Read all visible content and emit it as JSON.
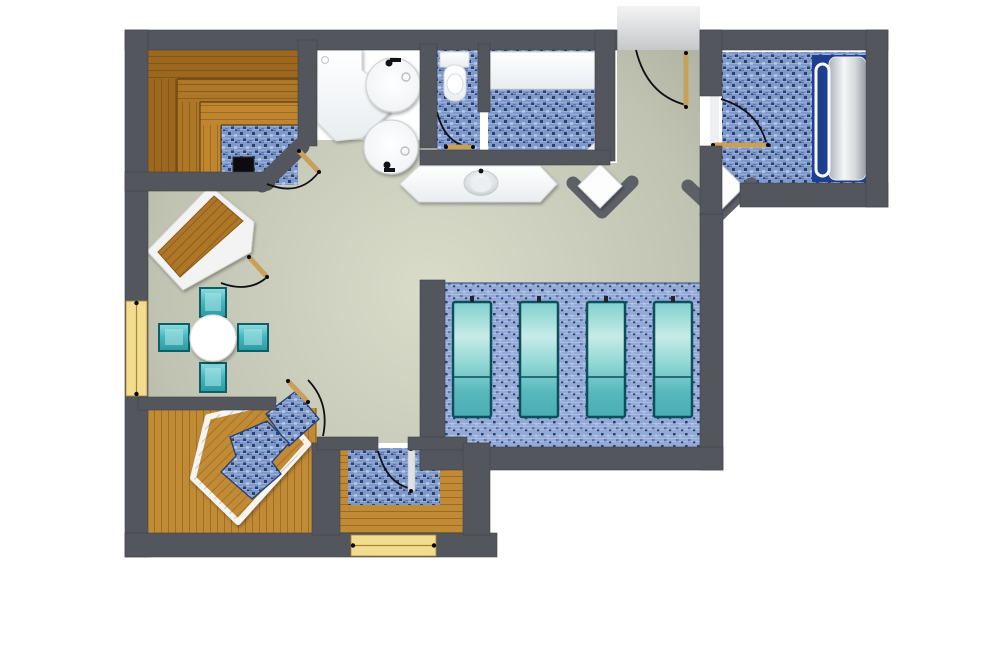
{
  "title": "Spa suite floor plan (top-down architectural rendering)",
  "palette": {
    "wall": "#54565e",
    "wall_edge": "#40424a",
    "corridor": "#c9cbcd",
    "tile_base": "#7e99cc",
    "tile_dark": "#2e3f6d",
    "tile_light": "#aabbdf",
    "tile_mid": "#5d77ab",
    "tile_base_light": "#93a9d8",
    "wood_dark": "#9c671e",
    "wood_mid": "#ae7627",
    "wood_light": "#c0862f",
    "wood_floor": "#c18a35",
    "wood_seam": "#53380c",
    "cream": "#f2dc90",
    "cream_seam": "#a8852f",
    "teal_dark": "#0d5e66",
    "navy": "#1e3f8f",
    "door_leaf": "#c9a05a",
    "arc": "#101014",
    "white_obj": "#f7f9fa",
    "white_edge": "#d4d8db"
  },
  "rooms": {
    "sauna": {
      "name": "Sauna",
      "floor": "blue mosaic tile",
      "features": [
        "three tiered wooden benches",
        "sauna heater"
      ]
    },
    "showers": {
      "name": "Shower area",
      "floor": "white",
      "features": [
        "angular shower tray",
        "2 round showers with fittings"
      ]
    },
    "wc": {
      "name": "WC",
      "floor": "blue mosaic tile",
      "features": [
        "toilet with cistern",
        "inward swing door"
      ]
    },
    "steam_room": {
      "name": "Steam room",
      "floor": "blue mosaic tile",
      "features": [
        "white bench along top wall"
      ]
    },
    "vanity": {
      "name": "Washbasin counter",
      "features": [
        "angled white counter",
        "oval basin with faucet"
      ]
    },
    "entrance": {
      "name": "Entrance",
      "features": [
        "opening in top wall",
        "wooden door leaf with swing arc"
      ]
    },
    "treatment_room": {
      "name": "Treatment room",
      "floor": "blue mosaic tile",
      "features": [
        "massage bed",
        "navy floor mat",
        "white side rail",
        "door with swing arc"
      ]
    },
    "lounger_terrace": {
      "name": "Relaxation platform",
      "floor": "light blue mosaic tile",
      "features": [
        "4 glass heated loungers"
      ]
    },
    "lounge": {
      "name": "Lounge",
      "floor": "sage green screed",
      "features": [
        "round white table",
        "4 teal cube stools",
        "diagonal corner bench cabin"
      ]
    },
    "whirlpool_room": {
      "name": "Whirlpool room",
      "floor": "wood planks",
      "features": [
        "pentagonal white-rimmed wooden surround",
        "mosaic plunge pool",
        "glass door"
      ]
    },
    "wet_room": {
      "name": "Wet room",
      "floor": "wood planks with mosaic shower zone",
      "features": [
        "swing door",
        "exterior cream door"
      ]
    }
  },
  "counts": {
    "heated_loungers": 4,
    "teal_stools": 4,
    "round_showers": 2,
    "diamond_seats": 2,
    "door_arcs": 8,
    "cream_openings": 2
  }
}
